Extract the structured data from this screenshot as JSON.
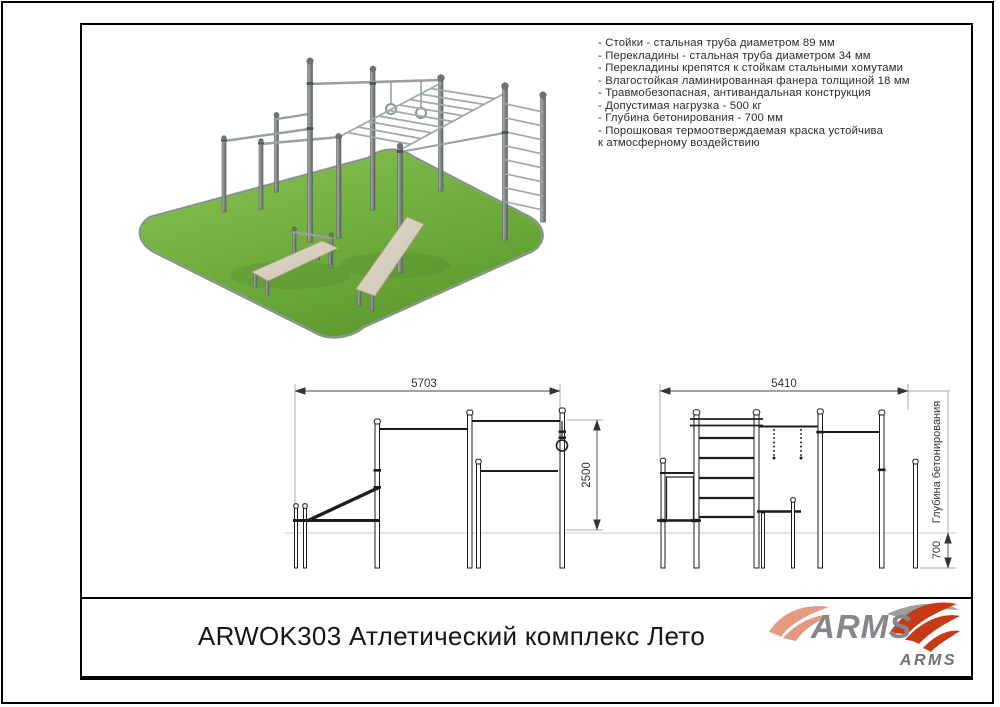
{
  "specs": {
    "lines": [
      "- Стойки - стальная труба диаметром 89 мм",
      "- Перекладины - стальная труба диаметром 34 мм",
      "- Перекладины крепятся к стойкам стальными хомутами",
      "- Влагостойкая ламинированная фанера толщиной 18 мм",
      "- Травмобезопасная, антивандальная конструкция",
      "- Допустимая нагрузка - 500 кг",
      "- Глубина бетонирования - 700 мм",
      "- Порошковая термоотверждаемая краска устойчива",
      "к атмосферному воздействию"
    ]
  },
  "drawings": {
    "left_view": {
      "width_mm": "5703",
      "height_mm": "2500"
    },
    "right_view": {
      "width_mm": "5410",
      "foundation_depth_mm": "700",
      "foundation_caption": "Глубина бетонирования"
    }
  },
  "title_block": {
    "title": "ARWOK303 Атлетический комплекс Лето",
    "brand": "ARMS",
    "brand_small": "ARMS"
  },
  "colors": {
    "brand_red": "#c63a16",
    "brand_gray": "#85878a",
    "grass_green": "#72ab41",
    "steel_gray": "#8b9290",
    "bench_beige": "#d9cfbf"
  }
}
